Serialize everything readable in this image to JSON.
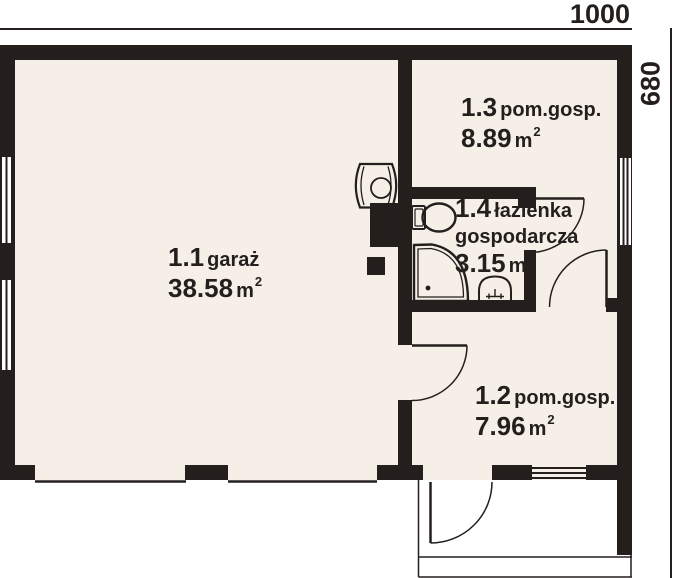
{
  "plan": {
    "dimensions": {
      "width_label": "1000",
      "height_label": "680"
    },
    "rooms": [
      {
        "number": "1.1",
        "name": "garaż",
        "area": "38.58",
        "area_unit": "m",
        "area_exp": "2"
      },
      {
        "number": "1.2",
        "name": "pom.gosp.",
        "area": "7.96",
        "area_unit": "m",
        "area_exp": "2"
      },
      {
        "number": "1.3",
        "name": "pom.gosp.",
        "area": "8.89",
        "area_unit": "m",
        "area_exp": "2"
      },
      {
        "number": "1.4",
        "name": "łazienka",
        "name2": "gospodarcza",
        "area": "3.15",
        "area_unit": "m",
        "area_exp": "2"
      }
    ],
    "fixtures": [
      "water-heater",
      "toilet",
      "shower",
      "washbasin"
    ],
    "doors": [
      "door-bathroom",
      "door-hall-to-1-2",
      "door-garage-to-1-2",
      "door-exterior-1-2"
    ],
    "windows": [
      "window-left-upper",
      "window-left-lower",
      "window-right",
      "window-bottom-1-2"
    ],
    "colors": {
      "wall": "#241f1d",
      "floor": "#f5efe7",
      "background": "#ffffff",
      "line": "#241f1d"
    }
  }
}
